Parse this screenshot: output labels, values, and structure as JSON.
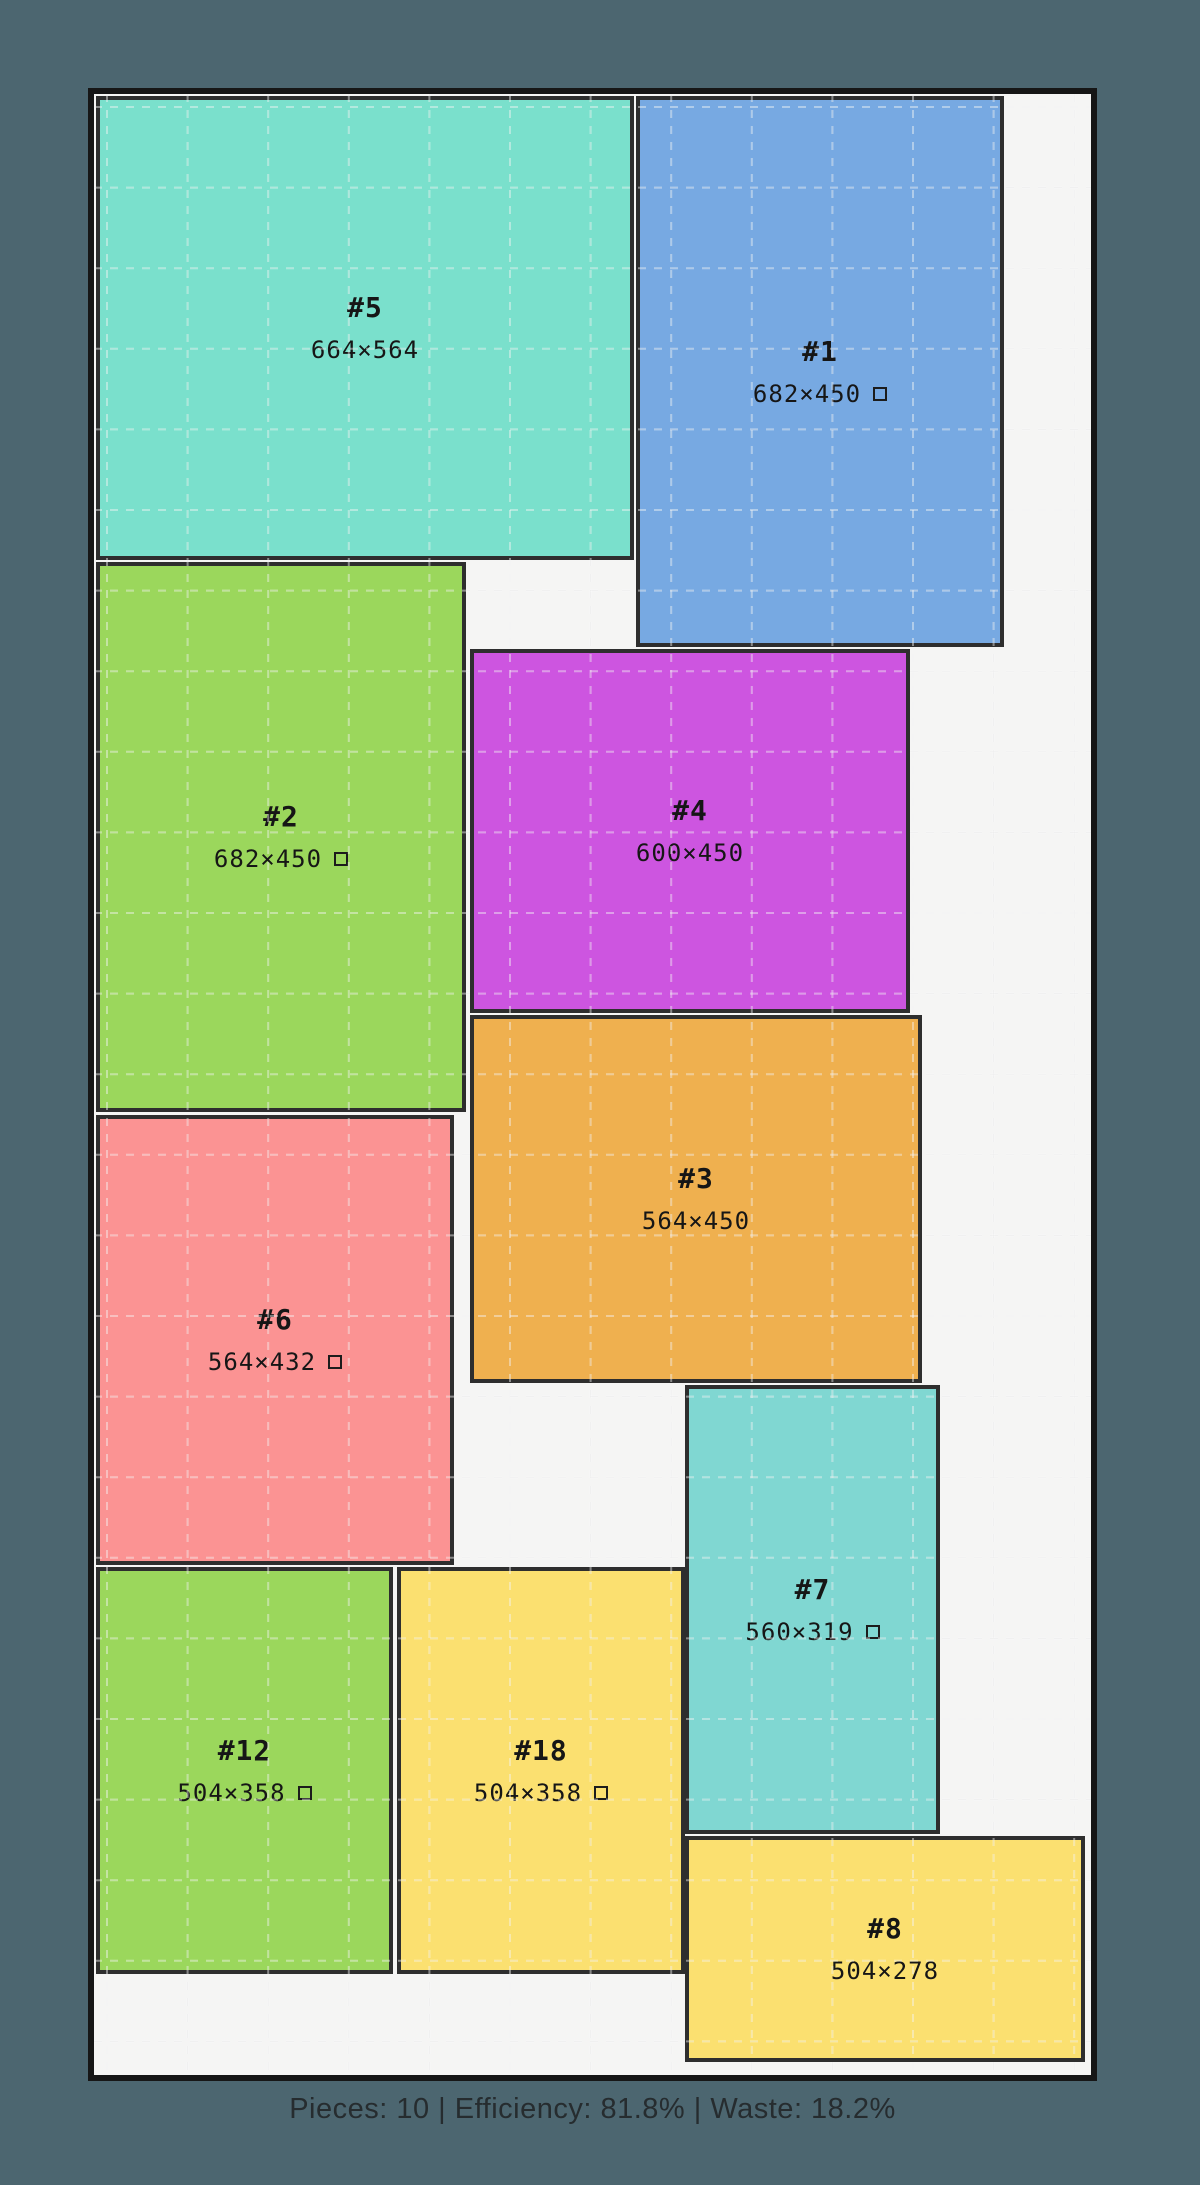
{
  "scene": {
    "background_color": "#4c6670",
    "sheet_fill": "#f5f5f4",
    "sheet_border_color": "#161616",
    "piece_stroke_color": "#2e2e2e",
    "label_color": "#161616",
    "grid_spacing": 80.6
  },
  "sheet": {
    "x": 88,
    "y": 88,
    "width": 1009,
    "height": 1993,
    "border_width": 6
  },
  "pieces": [
    {
      "id": "#5",
      "dims": "664×564",
      "rotated": false,
      "color": "#7ae0cc",
      "x": 96,
      "y": 96,
      "w": 538,
      "h": 464
    },
    {
      "id": "#1",
      "dims": "682×450",
      "rotated": true,
      "color": "#77a9e2",
      "x": 636,
      "y": 96,
      "w": 368,
      "h": 551
    },
    {
      "id": "#2",
      "dims": "682×450",
      "rotated": true,
      "color": "#9bd75c",
      "x": 96,
      "y": 562,
      "w": 370,
      "h": 550
    },
    {
      "id": "#4",
      "dims": "600×450",
      "rotated": false,
      "color": "#cd55e0",
      "x": 470,
      "y": 649,
      "w": 440,
      "h": 364
    },
    {
      "id": "#3",
      "dims": "564×450",
      "rotated": false,
      "color": "#efb04f",
      "x": 470,
      "y": 1015,
      "w": 452,
      "h": 368
    },
    {
      "id": "#6",
      "dims": "564×432",
      "rotated": true,
      "color": "#fb9393",
      "x": 96,
      "y": 1115,
      "w": 358,
      "h": 450
    },
    {
      "id": "#7",
      "dims": "560×319",
      "rotated": true,
      "color": "#80d7d2",
      "x": 685,
      "y": 1385,
      "w": 255,
      "h": 449
    },
    {
      "id": "#12",
      "dims": "504×358",
      "rotated": true,
      "color": "#9bd75c",
      "x": 96,
      "y": 1567,
      "w": 297,
      "h": 407
    },
    {
      "id": "#18",
      "dims": "504×358",
      "rotated": true,
      "color": "#fbe070",
      "x": 397,
      "y": 1567,
      "w": 288,
      "h": 407
    },
    {
      "id": "#8",
      "dims": "504×278",
      "rotated": false,
      "color": "#fbe070",
      "x": 685,
      "y": 1836,
      "w": 400,
      "h": 226
    }
  ],
  "footer": {
    "status": "Pieces: 10 | Efficiency: 81.8% | Waste: 18.2%"
  }
}
